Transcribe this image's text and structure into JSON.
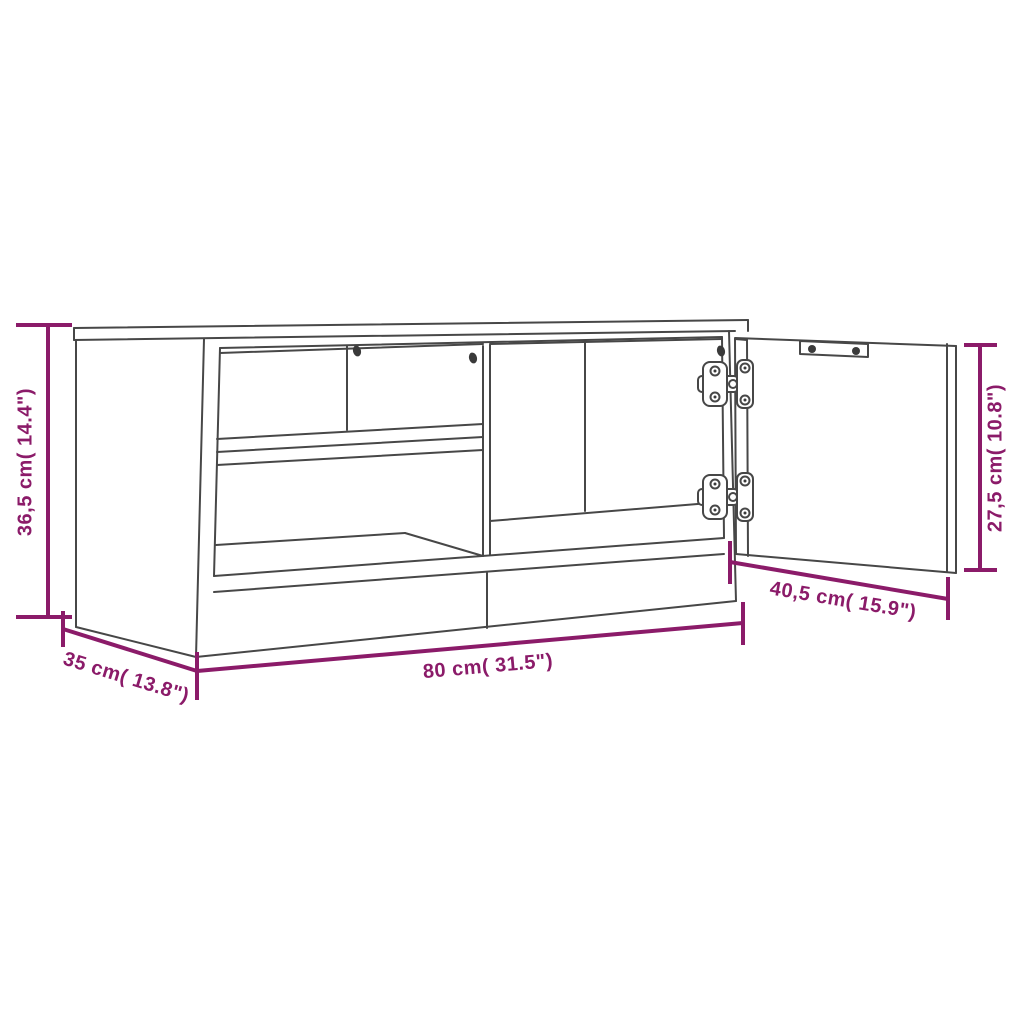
{
  "style": {
    "accent_color": "#8b1b69",
    "line_color": "#474747",
    "background": "#ffffff"
  },
  "dimensions": {
    "height": {
      "value_cm": "36,5",
      "value_in": "14.4",
      "label": "36,5 cm( 14.4\")"
    },
    "depth": {
      "value_cm": "35",
      "value_in": "13.8",
      "label": "35 cm( 13.8\")"
    },
    "width": {
      "value_cm": "80",
      "value_in": "31.5",
      "label": "80 cm( 31.5\")"
    },
    "door_width": {
      "value_cm": "40,5",
      "value_in": "15.9",
      "label": "40,5 cm( 15.9\")"
    },
    "door_height": {
      "value_cm": "27,5",
      "value_in": "10.8",
      "label": "27,5 cm( 10.8\")"
    }
  }
}
